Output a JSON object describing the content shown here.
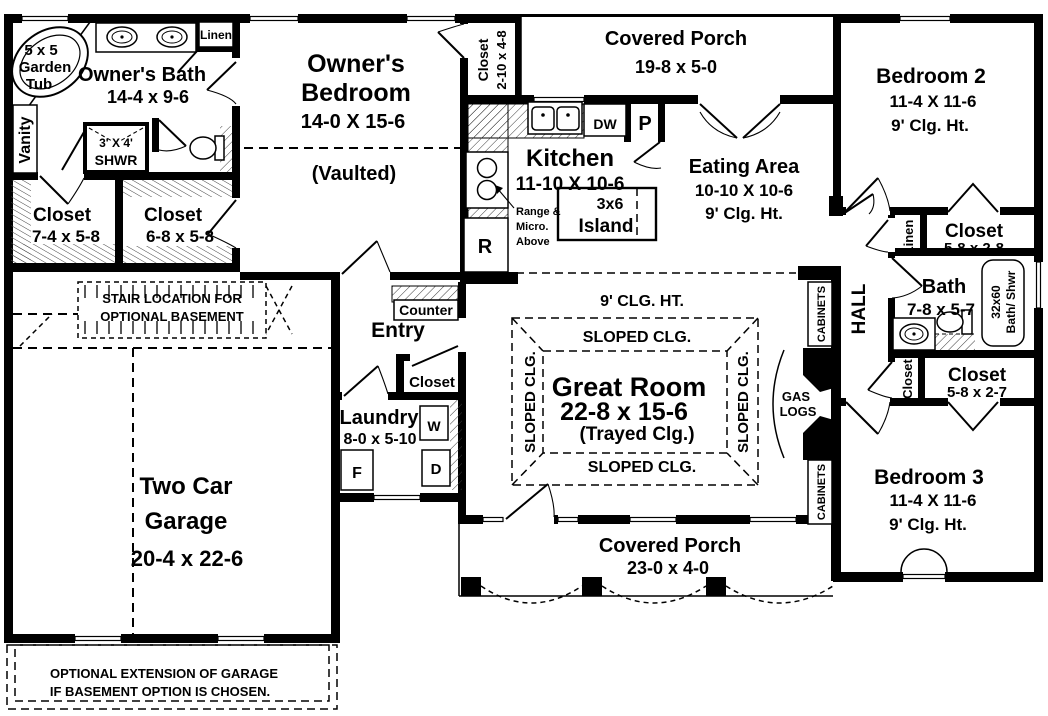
{
  "plan": {
    "colors": {
      "wall": "#000000",
      "background": "#ffffff"
    },
    "owners_bath": {
      "name": "Owner's Bath",
      "dims": "14-4 x 9-6",
      "tub_lines": [
        "5 x 5",
        "Garden",
        "Tub"
      ],
      "vanity": "Vanity",
      "linen": "Linen",
      "shower_lines": [
        "3' X 4'",
        "SHWR"
      ]
    },
    "owners_closet1": {
      "name": "Closet",
      "dims": "7-4 x 5-8"
    },
    "owners_closet2": {
      "name": "Closet",
      "dims": "6-8 x 5-8"
    },
    "owners_bedroom": {
      "line1": "Owner's",
      "line2": "Bedroom",
      "dims": "14-0 X 15-6",
      "note": "(Vaulted)"
    },
    "hall_closet_top": {
      "name": "Closet",
      "dims": "2-10 x 4-8"
    },
    "porch_top": {
      "name": "Covered Porch",
      "dims": "19-8 x 5-0"
    },
    "kitchen": {
      "name": "Kitchen",
      "dims": "11-10 X 10-6",
      "island_line1": "3x6",
      "island_line2": "Island",
      "range_note": [
        "Range &",
        "Micro.",
        "Above"
      ],
      "dw": "DW",
      "pantry": "P",
      "fridge": "R"
    },
    "eating": {
      "name": "Eating Area",
      "dims": "10-10 X 10-6",
      "clg": "9' Clg. Ht."
    },
    "bedroom2": {
      "name": "Bedroom 2",
      "dims": "11-4 X 11-6",
      "clg": "9' Clg. Ht."
    },
    "wing": {
      "linen": "Linen",
      "closet_b2_name": "Closet",
      "closet_b2_dims": "5-8 x 2-8",
      "bath_name": "Bath",
      "bath_dims": "7-8 x 5-7",
      "tub_line1": "32x60",
      "tub_line2": "Bath/ Shwr",
      "hall": "HALL",
      "closet_hall": "Closet",
      "closet_b3_name": "Closet",
      "closet_b3_dims": "5-8 x 2-7"
    },
    "bedroom3": {
      "name": "Bedroom 3",
      "dims": "11-4 X 11-6",
      "clg": "9' Clg. Ht."
    },
    "great_room": {
      "clg": "9' CLG. HT.",
      "sloped": "SLOPED CLG.",
      "name": "Great Room",
      "dims": "22-8 x 15-6",
      "note": "(Trayed Clg.)",
      "cabinets": "CABINETS",
      "gas_line1": "GAS",
      "gas_line2": "LOGS"
    },
    "entry": {
      "name": "Entry",
      "counter": "Counter",
      "closet": "Closet"
    },
    "laundry": {
      "name": "Laundry",
      "dims": "8-0 x 5-10",
      "washer": "W",
      "dryer": "D",
      "freezer": "F"
    },
    "garage": {
      "line1": "Two Car",
      "line2": "Garage",
      "dims": "20-4 x 22-6",
      "stair_note1": "STAIR LOCATION FOR",
      "stair_note2": "OPTIONAL BASEMENT",
      "ext_note1": "OPTIONAL EXTENSION OF GARAGE",
      "ext_note2": "IF BASEMENT OPTION IS CHOSEN."
    },
    "porch_bottom": {
      "name": "Covered Porch",
      "dims": "23-0 x 4-0"
    }
  }
}
